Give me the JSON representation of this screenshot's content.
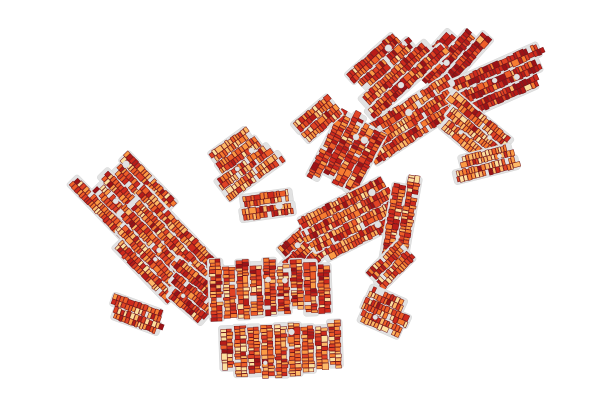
{
  "map": {
    "type": "parcel-choropleth",
    "background_color": "#ffffff",
    "street_color": "#e2e2e2",
    "street_edge_color": "#cfcfcf",
    "parcel_stroke": "#701114",
    "palette": [
      "#9c1216",
      "#b81c18",
      "#ce2a1d",
      "#e04325",
      "#ee5e29",
      "#f67c31",
      "#fb9a45",
      "#fdb968",
      "#fcdf9e"
    ],
    "bias_weights": {
      "dark": [
        22,
        26,
        20,
        13,
        8,
        5,
        3,
        2,
        1
      ],
      "red": [
        8,
        14,
        18,
        19,
        15,
        11,
        8,
        4,
        3
      ],
      "mixed": [
        3,
        7,
        11,
        15,
        17,
        16,
        13,
        10,
        8
      ],
      "amber": [
        2,
        4,
        7,
        11,
        15,
        17,
        16,
        15,
        13
      ],
      "light": [
        1,
        3,
        5,
        8,
        11,
        15,
        19,
        20,
        18
      ]
    },
    "parcel": {
      "width": 3.4,
      "depth": 5.6
    },
    "clusters": [
      {
        "id": "fan-west",
        "cx": 449,
        "cy": 58,
        "angle": -48,
        "strips": 3,
        "len": 82,
        "pitch": 14,
        "bias": "dark",
        "seed": 11,
        "taper": [
          0.55,
          1
        ],
        "holes": 1
      },
      {
        "id": "fan-east",
        "cx": 490,
        "cy": 86,
        "angle": -24,
        "strips": 3,
        "len": 96,
        "pitch": 14,
        "bias": "dark",
        "seed": 12,
        "taper": [
          1,
          0.8
        ],
        "holes": 2
      },
      {
        "id": "north-central",
        "cx": 390,
        "cy": 70,
        "angle": -42,
        "strips": 4,
        "len": 92,
        "pitch": 13.5,
        "bias": "red",
        "seed": 13,
        "taper": [
          0.7,
          1
        ],
        "holes": 3
      },
      {
        "id": "north-band",
        "cx": 408,
        "cy": 122,
        "angle": -33,
        "strips": 3,
        "len": 108,
        "pitch": 13,
        "bias": "mixed",
        "seed": 14,
        "taper": [
          1,
          1
        ],
        "holes": 2
      },
      {
        "id": "east-upper-light",
        "cx": 472,
        "cy": 130,
        "angle": 40,
        "strips": 3,
        "len": 68,
        "pitch": 13,
        "bias": "light",
        "seed": 15,
        "taper": [
          1,
          0.75
        ],
        "holes": 2
      },
      {
        "id": "east-lower-light",
        "cx": 486,
        "cy": 163,
        "angle": -14,
        "strips": 2,
        "len": 58,
        "pitch": 13,
        "bias": "light",
        "seed": 16,
        "taper": [
          1,
          1
        ],
        "holes": 1
      },
      {
        "id": "mid-dark-block",
        "cx": 348,
        "cy": 152,
        "angle": -62,
        "strips": 4,
        "len": 78,
        "pitch": 13,
        "bias": "red",
        "seed": 17,
        "taper": [
          0.85,
          1
        ],
        "holes": 2
      },
      {
        "id": "mid-small",
        "cx": 316,
        "cy": 120,
        "angle": -40,
        "strips": 2,
        "len": 44,
        "pitch": 13,
        "bias": "mixed",
        "seed": 18,
        "taper": [
          1,
          1
        ],
        "holes": 0
      },
      {
        "id": "center-west",
        "cx": 240,
        "cy": 162,
        "angle": -36,
        "strips": 4,
        "len": 62,
        "pitch": 13,
        "bias": "amber",
        "seed": 19,
        "taper": [
          0.8,
          1
        ],
        "holes": 2
      },
      {
        "id": "center-loop",
        "cx": 268,
        "cy": 205,
        "angle": -8,
        "strips": 2,
        "len": 56,
        "pitch": 13,
        "bias": "mixed",
        "seed": 20,
        "taper": [
          1,
          1
        ],
        "holes": 1
      },
      {
        "id": "center-hook",
        "cx": 312,
        "cy": 243,
        "angle": -42,
        "strips": 3,
        "len": 62,
        "pitch": 13,
        "bias": "red",
        "seed": 21,
        "taper": [
          1,
          1
        ],
        "holes": 1
      },
      {
        "id": "center-ladder",
        "cx": 352,
        "cy": 220,
        "angle": -27,
        "strips": 4,
        "len": 102,
        "pitch": 13,
        "bias": "mixed",
        "seed": 22,
        "taper": [
          1,
          0.85
        ],
        "holes": 2
      },
      {
        "id": "center-vertical",
        "cx": 400,
        "cy": 222,
        "angle": -80,
        "strips": 2,
        "len": 88,
        "pitch": 13.5,
        "bias": "mixed",
        "seed": 23,
        "taper": [
          1,
          1
        ],
        "holes": 1
      },
      {
        "id": "center-southeast",
        "cx": 390,
        "cy": 266,
        "angle": -45,
        "strips": 2,
        "len": 46,
        "pitch": 13,
        "bias": "mixed",
        "seed": 31,
        "taper": [
          1,
          1
        ],
        "holes": 0
      },
      {
        "id": "west-upper",
        "cx": 130,
        "cy": 201,
        "angle": 46,
        "strips": 5,
        "len": 98,
        "pitch": 13.5,
        "bias": "mixed",
        "seed": 24,
        "taper": [
          0.65,
          1
        ],
        "holes": 4
      },
      {
        "id": "west-mid",
        "cx": 163,
        "cy": 252,
        "angle": 46,
        "strips": 5,
        "len": 110,
        "pitch": 13.5,
        "bias": "mixed",
        "seed": 25,
        "taper": [
          1,
          0.8
        ],
        "holes": 4
      },
      {
        "id": "west-lower",
        "cx": 196,
        "cy": 296,
        "angle": 40,
        "strips": 3,
        "len": 70,
        "pitch": 13,
        "bias": "red",
        "seed": 26,
        "taper": [
          1,
          0.7
        ],
        "holes": 1
      },
      {
        "id": "west-tail",
        "cx": 136,
        "cy": 314,
        "angle": 20,
        "strips": 2,
        "len": 44,
        "pitch": 12.5,
        "bias": "mixed",
        "seed": 27,
        "taper": [
          1,
          1
        ],
        "holes": 0
      },
      {
        "id": "south-comb-upper",
        "cx": 270,
        "cy": 287,
        "angle": 88,
        "strips": 9,
        "len": 54,
        "pitch": 13.5,
        "bias": "mixed",
        "seed": 28,
        "taper": [
          1,
          1
        ],
        "holes": 2
      },
      {
        "id": "south-comb-lower",
        "cx": 281,
        "cy": 348,
        "angle": 88,
        "strips": 9,
        "len": 46,
        "pitch": 13.5,
        "bias": "amber",
        "seed": 29,
        "taper": [
          1,
          1
        ],
        "holes": 2
      },
      {
        "id": "south-hook",
        "cx": 383,
        "cy": 311,
        "angle": 24,
        "strips": 3,
        "len": 50,
        "pitch": 13,
        "bias": "amber",
        "seed": 30,
        "taper": [
          0.8,
          1
        ],
        "holes": 1
      }
    ]
  }
}
